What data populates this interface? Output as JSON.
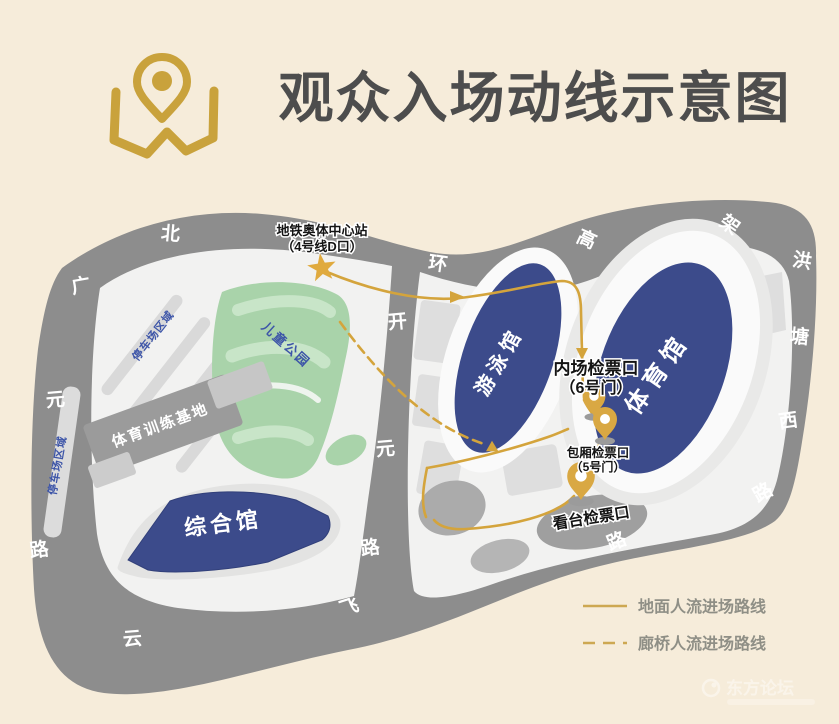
{
  "title": "观众入场动线示意图",
  "station": {
    "line1": "地铁奥体中心站",
    "line2": "（4号线D口）"
  },
  "roads": {
    "north_ring": {
      "name": "北环高架",
      "chars": [
        "北",
        "环",
        "高",
        "架"
      ]
    },
    "hongtang_west": {
      "name": "洪塘西路",
      "chars": [
        "洪",
        "塘",
        "西",
        "路"
      ]
    },
    "guangyuan": {
      "name": "广元路",
      "chars": [
        "广",
        "元",
        "路"
      ]
    },
    "yunfei": {
      "name": "云飞路",
      "chars": [
        "云",
        "飞",
        "路"
      ]
    },
    "kaiyuan": {
      "name": "开元路",
      "chars": [
        "开",
        "元",
        "路"
      ]
    }
  },
  "areas": {
    "children_park": "儿童公园",
    "parking_upper": "停车场区域",
    "parking_left": "停车场区域",
    "training_base": "体育训练基地",
    "comprehensive_hall": "综合馆",
    "swimming_hall": "游泳馆",
    "gymnasium": "体育馆"
  },
  "checkpoints": {
    "infield": {
      "line1": "内场检票口",
      "line2": "（6号门）"
    },
    "box": {
      "line1": "包厢检票口",
      "line2": "（5号门）"
    },
    "stand": {
      "label": "看台检票口"
    }
  },
  "legend": [
    {
      "style": "solid",
      "label": "地面人流进场路线"
    },
    {
      "style": "dashed",
      "label": "廊桥人流进场路线"
    }
  ],
  "watermark": {
    "text": "东方论坛"
  },
  "colors": {
    "background": "#f6ecda",
    "road_gray": "#8d8d8d",
    "building_navy": "#3c4b8b",
    "park_green": "#a9d3aa",
    "accent_gold": "#cda33f",
    "label_blue": "#3d55a8"
  }
}
